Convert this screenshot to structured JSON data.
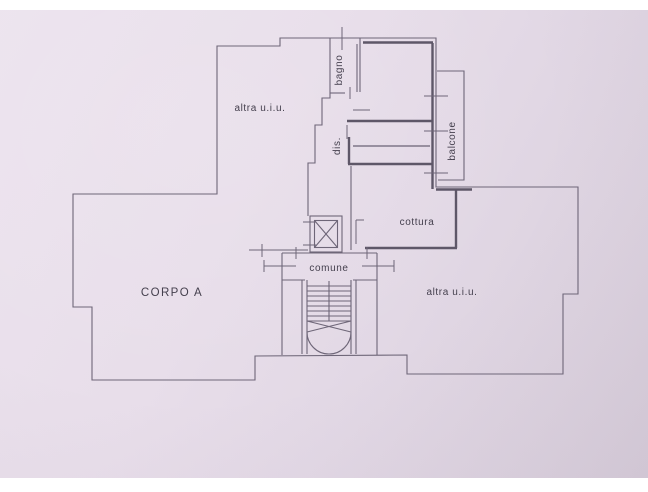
{
  "document": {
    "background_color": "#ffffff",
    "paper_color": "#e7dde9",
    "line_color": "#6e6678",
    "thick_wall_color": "#5e5768",
    "text_color": "#45404e"
  },
  "floorplan": {
    "labels": {
      "upper_left_unit": "altra u.i.u.",
      "bathroom": "bagno",
      "hallway": "dis.",
      "balcony": "balcone",
      "kitchen": "cottura",
      "common_area": "comune",
      "building_body": "CORPO A",
      "lower_right_unit": "altra u.i.u."
    }
  }
}
